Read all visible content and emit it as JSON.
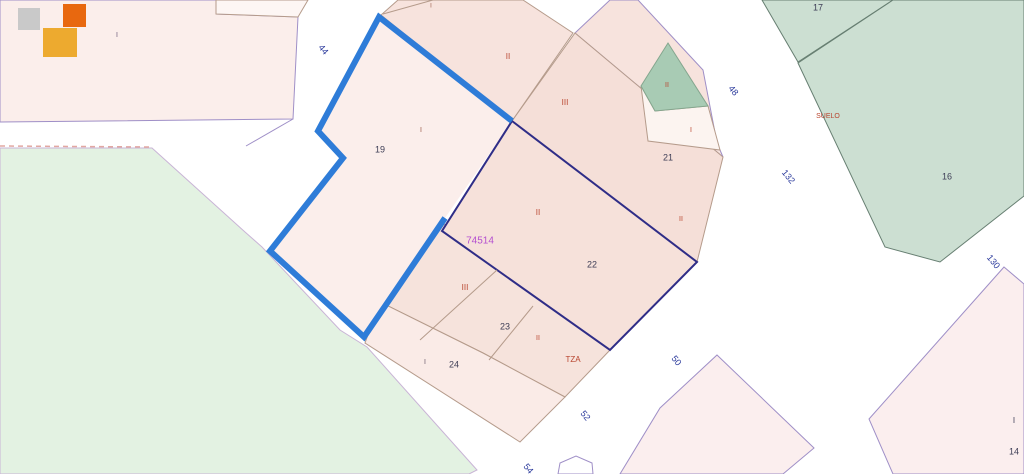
{
  "app": {
    "title": "Cadastral parcel map viewer",
    "block_number": "74514"
  },
  "map": {
    "width": 1024,
    "height": 474,
    "background": "#ffffff",
    "highlight_color": "#2e7cd8",
    "parcel_border_navy": "#2f2d87",
    "parcel_border_tan": "#b59b8b",
    "street_edge_purple": "#9f8fc7",
    "shapes": [
      {
        "t": "poly",
        "name": "green-field",
        "pts": "0,148 152,148 245,232 262,247 340,330 367,347 477,470 469,474 0,474",
        "fill": "#e3f2e2",
        "stroke": "#c9b4d6",
        "w": 1
      },
      {
        "t": "poly",
        "name": "parcel-topleft",
        "pts": "0,0 216,0 216,14 298,17 293,119 0,122",
        "fill": "#fbeeeb",
        "stroke": "#9f8fc7",
        "w": 1
      },
      {
        "t": "poly",
        "name": "parcel-top-notch",
        "pts": "216,0 308,0 298,17 216,14",
        "fill": "#fdf6f4",
        "stroke": "#b59b8b",
        "w": 1
      },
      {
        "t": "poly",
        "name": "parcel-II-top",
        "pts": "381,15 398,0 523,0 573,33 512,121",
        "fill": "#f7e3dd",
        "stroke": "#b59b8b",
        "w": 1
      },
      {
        "t": "poly",
        "name": "parcel-21-upper",
        "pts": "575,33 610,0 638,0 703,70 717,143 723,157",
        "fill": "#f7e3dd",
        "stroke": "#9f8fc7",
        "w": 1
      },
      {
        "t": "poly",
        "name": "parcel-21-band",
        "pts": "512,121 575,33 723,157 697,262",
        "fill": "#f5dfd8",
        "stroke": "#b59b8b",
        "w": 1
      },
      {
        "t": "poly",
        "name": "parcel-21-inner-white",
        "pts": "641,86 655,111 708,106 720,150 648,141",
        "fill": "#fcf4f0",
        "stroke": "#b59b8b",
        "w": 1
      },
      {
        "t": "poly",
        "name": "parcel-21-green",
        "pts": "668,43 708,106 655,111 641,86",
        "fill": "#a8cbb4",
        "stroke": "#84a68e",
        "w": 1
      },
      {
        "t": "poly",
        "name": "parcel-23-band",
        "pts": "444,224 610,350 565,397 483,353 380,302 364,337",
        "fill": "#f6e3dc",
        "stroke": "#b59b8b",
        "w": 1
      },
      {
        "t": "poly",
        "name": "parcel-24",
        "pts": "380,302 483,353 565,397 520,442 365,343",
        "fill": "#faebe7",
        "stroke": "#b59b8b",
        "w": 1
      },
      {
        "t": "poly",
        "name": "parcel-19",
        "pts": "379,17 512,121 445,218 364,337 270,251 343,158 318,131",
        "fill": "#fbeeeb",
        "stroke": "none",
        "w": 0
      },
      {
        "t": "poly",
        "name": "parcel-22",
        "pts": "512,121 697,262 610,350 442,231",
        "fill": "#f6e1da",
        "stroke": "#2f2d87",
        "w": 2
      },
      {
        "t": "poly",
        "name": "parcel-bottom-diamond",
        "pts": "717,355 814,448 783,474 620,474 660,408",
        "fill": "#fbeeee",
        "stroke": "#9f8fc7",
        "w": 1
      },
      {
        "t": "poly",
        "name": "parcel-14",
        "pts": "1004,267 1024,284 1024,474 893,474 869,419",
        "fill": "#fbeeee",
        "stroke": "#9f8fc7",
        "w": 1
      },
      {
        "t": "poly",
        "name": "parcel-17",
        "pts": "762,0 798,62 893,0",
        "fill": "#ccdfd2",
        "stroke": "#677f72",
        "w": 1
      },
      {
        "t": "poly",
        "name": "parcel-16",
        "pts": "798,63 893,0 1024,0 1024,196 940,262 885,247",
        "fill": "#ccdfd2",
        "stroke": "#677f72",
        "w": 1
      },
      {
        "t": "poly",
        "name": "street-bottom-shape",
        "pts": "558,474 560,463 576,456 592,463 593,474",
        "fill": "#ffffff",
        "stroke": "#9f8fc7",
        "w": 1
      },
      {
        "t": "line",
        "name": "boundary-sliver",
        "pts": "433,0 383,14",
        "stroke": "#b59b8b",
        "w": 1
      },
      {
        "t": "line",
        "name": "boundary-23a",
        "pts": "497,270 420,340",
        "stroke": "#b59b8b",
        "w": 1
      },
      {
        "t": "line",
        "name": "boundary-23b",
        "pts": "533,306 489,360",
        "stroke": "#b59b8b",
        "w": 1
      },
      {
        "t": "line",
        "name": "street-edge-corner",
        "pts": "293,119 246,146",
        "stroke": "#9f8fc7",
        "w": 1
      },
      {
        "t": "line",
        "name": "street-dashed-edge",
        "pts": "0,146 153,147",
        "stroke": "#e2a8a2",
        "w": 1.5,
        "dash": "5,4"
      },
      {
        "t": "line",
        "name": "parcel-19-highlight-outline",
        "pts": "512,121 379,17 318,131 343,158 270,251 364,337 445,218",
        "stroke": "#2e7cd8",
        "w": 6
      }
    ],
    "labels": [
      {
        "text": "I",
        "x": 117,
        "y": 35,
        "fill": "#6a5a7a",
        "size": 7
      },
      {
        "text": "44",
        "x": 323,
        "y": 50,
        "fill": "#2b3a9c",
        "size": 9,
        "rot": 50
      },
      {
        "text": "I",
        "x": 431,
        "y": 6,
        "fill": "#9a5a48",
        "size": 6
      },
      {
        "text": "19",
        "x": 380,
        "y": 150,
        "fill": "#3d3d55",
        "size": 9
      },
      {
        "text": "I",
        "x": 421,
        "y": 130,
        "fill": "#9a5a48",
        "size": 7
      },
      {
        "text": "II",
        "x": 508,
        "y": 57,
        "fill": "#b8442e",
        "size": 8
      },
      {
        "text": "III",
        "x": 565,
        "y": 103,
        "fill": "#b8442e",
        "size": 8
      },
      {
        "text": "II",
        "x": 667,
        "y": 85,
        "fill": "#b8442e",
        "size": 7
      },
      {
        "text": "I",
        "x": 691,
        "y": 130,
        "fill": "#b8442e",
        "size": 7
      },
      {
        "text": "21",
        "x": 668,
        "y": 158,
        "fill": "#3d3d55",
        "size": 9
      },
      {
        "text": "II",
        "x": 681,
        "y": 219,
        "fill": "#b8442e",
        "size": 7
      },
      {
        "text": "17",
        "x": 818,
        "y": 8,
        "fill": "#3d3d55",
        "size": 9
      },
      {
        "text": "SUELO",
        "x": 828,
        "y": 116,
        "fill": "#b8442e",
        "size": 7
      },
      {
        "text": "48",
        "x": 733,
        "y": 91,
        "fill": "#2b3a9c",
        "size": 9,
        "rot": 50
      },
      {
        "text": "132",
        "x": 788,
        "y": 177,
        "fill": "#2b3a9c",
        "size": 9,
        "rot": 50
      },
      {
        "text": "16",
        "x": 947,
        "y": 177,
        "fill": "#3d3d55",
        "size": 9
      },
      {
        "text": "130",
        "x": 993,
        "y": 262,
        "fill": "#2b3a9c",
        "size": 9,
        "rot": 50
      },
      {
        "text": "74514",
        "x": 480,
        "y": 241,
        "fill": "#b44fd0",
        "size": 10
      },
      {
        "text": "II",
        "x": 538,
        "y": 213,
        "fill": "#b8442e",
        "size": 8
      },
      {
        "text": "22",
        "x": 592,
        "y": 265,
        "fill": "#3d3d55",
        "size": 9
      },
      {
        "text": "III",
        "x": 465,
        "y": 288,
        "fill": "#b8442e",
        "size": 8
      },
      {
        "text": "23",
        "x": 505,
        "y": 327,
        "fill": "#3d3d55",
        "size": 9
      },
      {
        "text": "II",
        "x": 538,
        "y": 338,
        "fill": "#b8442e",
        "size": 7
      },
      {
        "text": "TZA",
        "x": 573,
        "y": 360,
        "fill": "#b8442e",
        "size": 8
      },
      {
        "text": "I",
        "x": 425,
        "y": 362,
        "fill": "#6a5a6a",
        "size": 7
      },
      {
        "text": "24",
        "x": 454,
        "y": 365,
        "fill": "#3d3d55",
        "size": 9
      },
      {
        "text": "50",
        "x": 676,
        "y": 361,
        "fill": "#2b3a9c",
        "size": 9,
        "rot": 50
      },
      {
        "text": "52",
        "x": 585,
        "y": 416,
        "fill": "#2b3a9c",
        "size": 9,
        "rot": 50
      },
      {
        "text": "54",
        "x": 528,
        "y": 469,
        "fill": "#2b3a9c",
        "size": 9,
        "rot": 50
      },
      {
        "text": "I",
        "x": 1014,
        "y": 421,
        "fill": "#3d3d55",
        "size": 8
      },
      {
        "text": "14",
        "x": 1014,
        "y": 452,
        "fill": "#3d3d55",
        "size": 9
      }
    ],
    "logo": {
      "name": "map-service-logo",
      "squares": [
        {
          "name": "logo-square-gray",
          "x": 18,
          "y": 8,
          "w": 22,
          "h": 22,
          "fill": "#c9c9c9"
        },
        {
          "name": "logo-square-amber",
          "x": 43,
          "y": 28,
          "w": 34,
          "h": 29,
          "fill": "#edaa2f"
        },
        {
          "name": "logo-square-orange",
          "x": 63,
          "y": 4,
          "w": 23,
          "h": 23,
          "fill": "#e8680f"
        }
      ]
    }
  }
}
